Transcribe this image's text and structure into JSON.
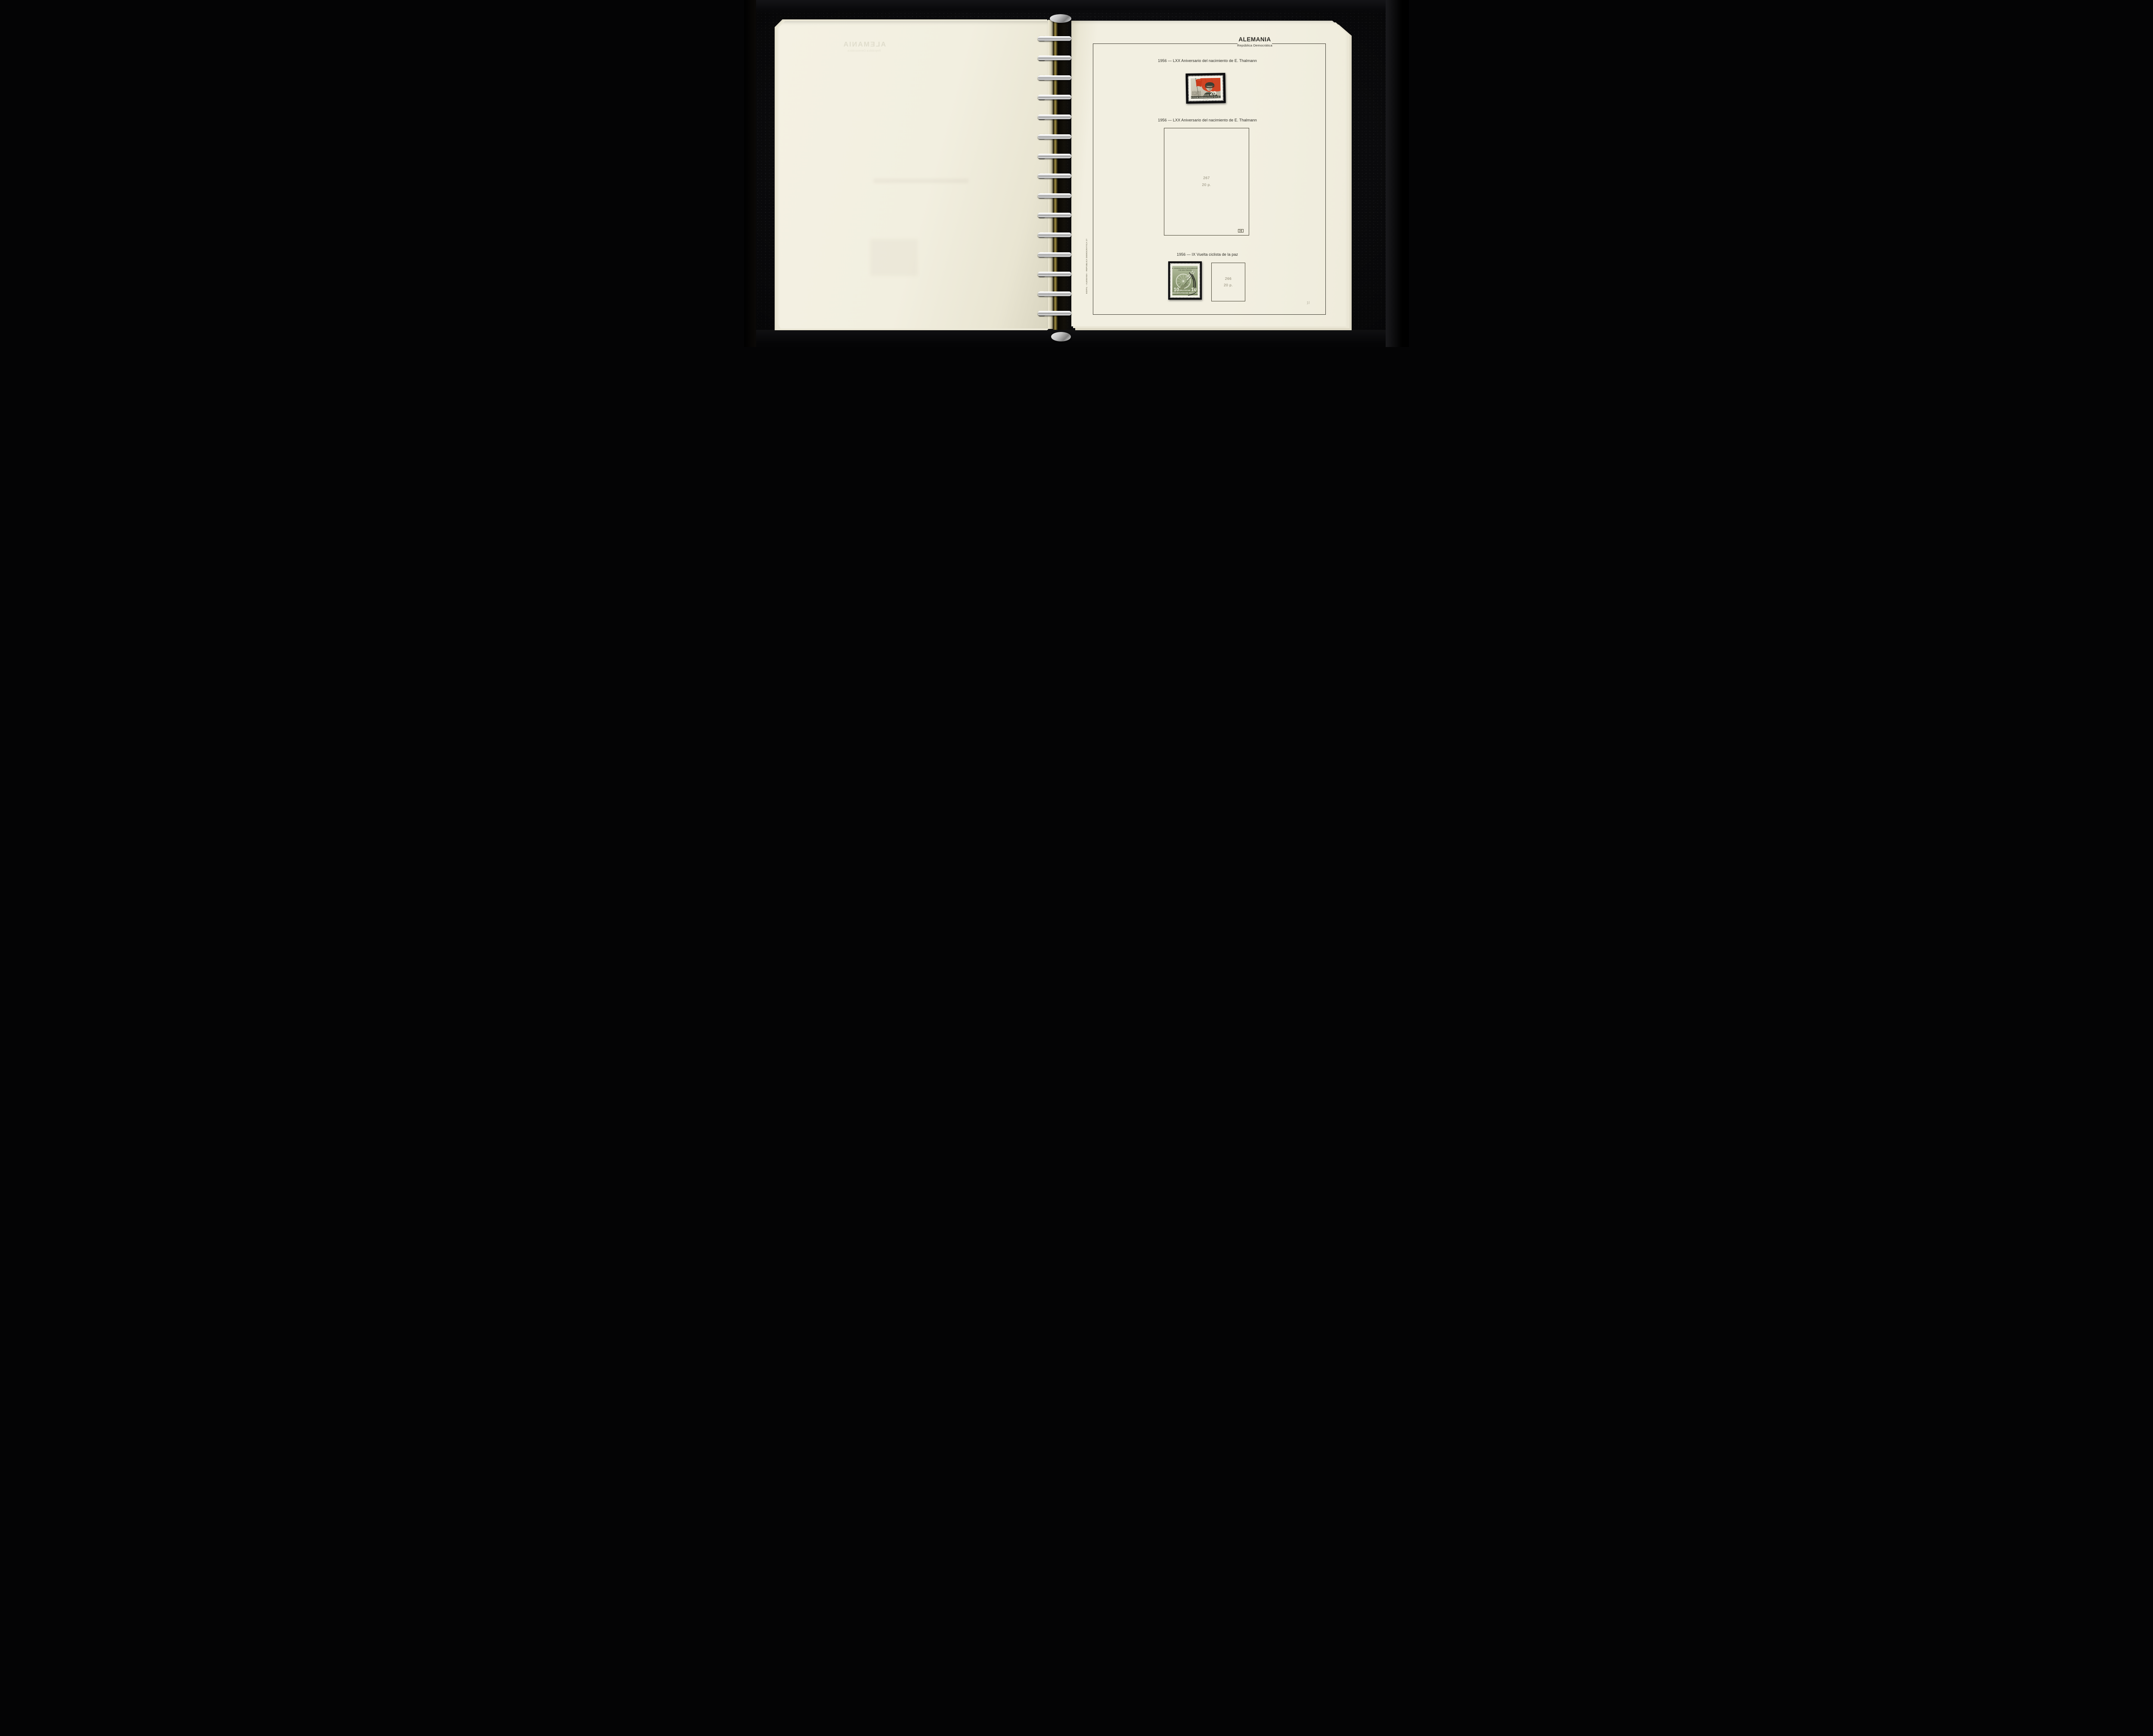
{
  "colors": {
    "page": "#f2efe1",
    "binder": "#0b0b0d",
    "flag_red": "#d14524",
    "stamp_green": "#94a07b",
    "frame_line": "#3c3a30",
    "muted": "#8c8672",
    "ink": "#2e2d27",
    "metal": "#d9d9d9",
    "brass": "#8a7838"
  },
  "binder": {
    "ring_count": 15
  },
  "left_page": {
    "ghost_title": "ALEMANIA",
    "ghost_subtitle": "República Democrática"
  },
  "right_page": {
    "header": {
      "title": "ALEMANIA",
      "subtitle": "República Democrática"
    },
    "captions": [
      "1956 — LXX Aniversario del nacimiento de E. Thalmann",
      "1956 — LXX Aniversario del nacimiento de E. Thalmann",
      "1956 — IX Vuelta ciclista de la paz"
    ],
    "placeholders": [
      {
        "number": "267",
        "value": "20 p."
      },
      {
        "number": "266",
        "value": "20 p."
      }
    ],
    "spine_text": "EDIFIL - ALEMANIA - REPUBLICA DEMOCRATICA 27",
    "pencil_note": "1t"
  },
  "stamps": {
    "thalmann": {
      "years": "1886 - 1956",
      "name": "ERNST THÄLMANN",
      "country": "DEUTSCHE DEMOKRATISCHE REPUBLIK",
      "value": "20",
      "engraver": "EIGLER"
    },
    "cycling": {
      "title_line1": "IX. INTERNATIONALE RADFERNFAHRT",
      "title_line2": "FÜR DEN FRIEDEN",
      "value_left": "10",
      "value_right": "10",
      "country_line1": "DEUTSCHE",
      "country_line2": "DEMOKRATISCHE REPUBLIK",
      "postmark": "BER"
    }
  }
}
